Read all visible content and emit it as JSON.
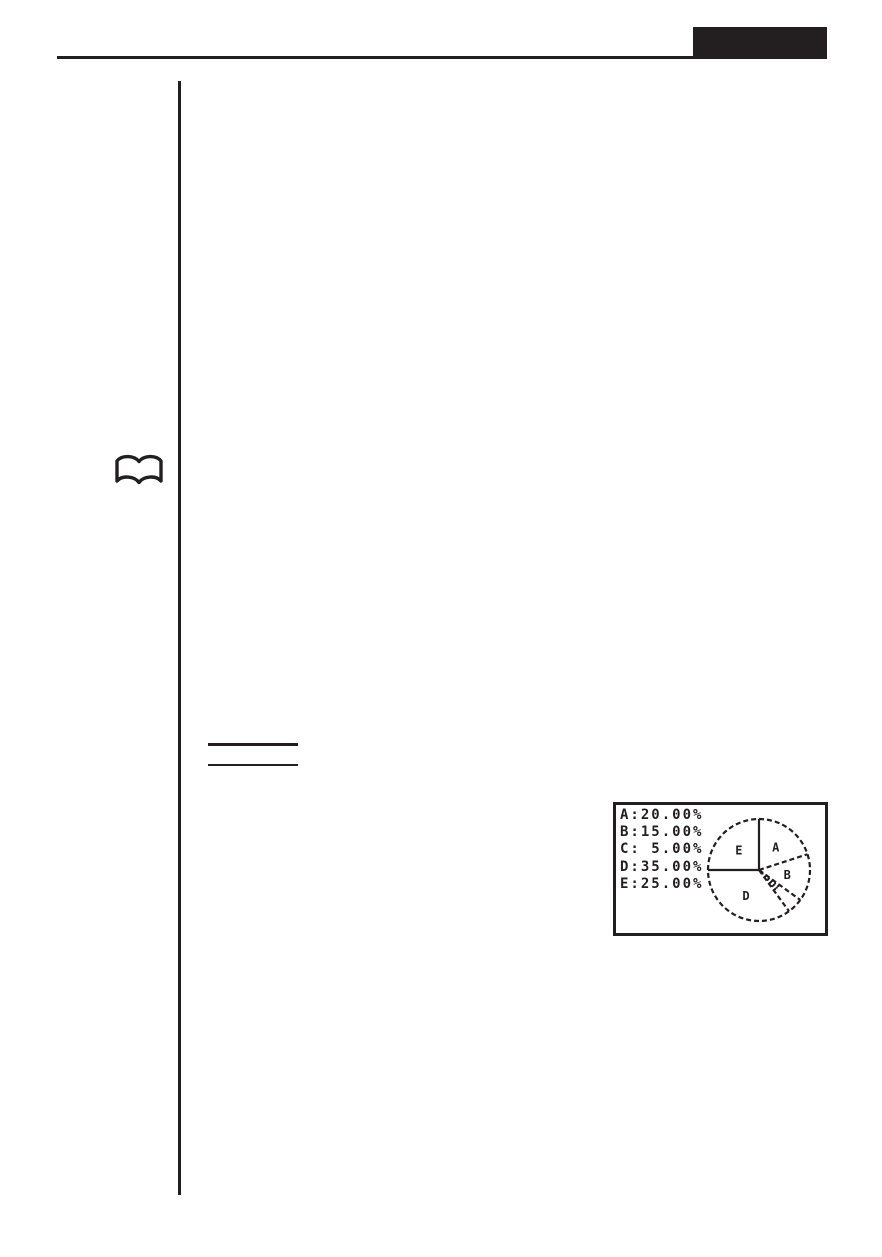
{
  "page": {
    "ink": "#231f20",
    "background": "#ffffff"
  },
  "header": {
    "tab_color": "#231f20"
  },
  "margin": {
    "book_icon": "open-book"
  },
  "chart_data": {
    "type": "pie",
    "categories": [
      "A",
      "B",
      "C",
      "D",
      "E"
    ],
    "values": [
      20.0,
      15.0,
      5.0,
      35.0,
      25.0
    ],
    "unit": "%",
    "legend_position": "left",
    "legend_entries": [
      "A:20.00%",
      "B:15.00%",
      "C: 5.00%",
      "D:35.00%",
      "E:25.00%"
    ],
    "start_angle": "top",
    "direction": "clockwise",
    "slice_labels_visible": [
      "A",
      "B",
      "D",
      "E"
    ],
    "shaded_slices": [
      "C"
    ],
    "outline_style": "dashed"
  }
}
